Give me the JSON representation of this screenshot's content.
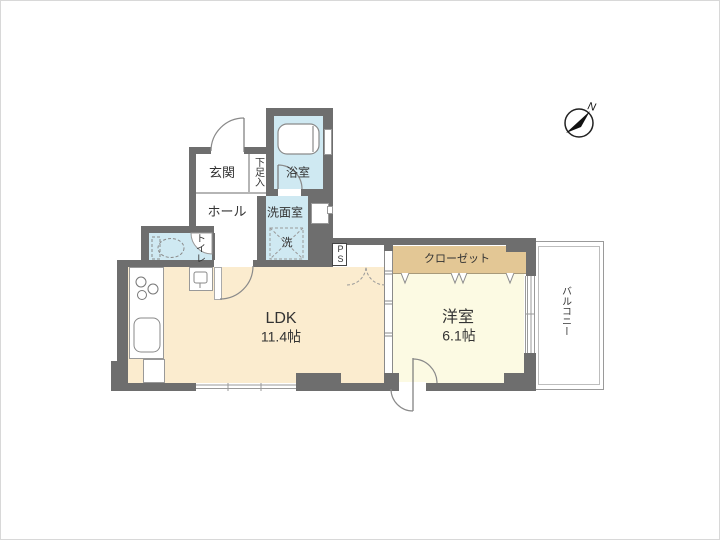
{
  "plan": {
    "type": "apartment-floor-plan",
    "rooms": {
      "genkan": {
        "label": "玄関"
      },
      "shoebox": {
        "label": "下足入"
      },
      "hall": {
        "label": "ホール"
      },
      "bath": {
        "label": "浴室"
      },
      "washroom": {
        "label": "洗面室"
      },
      "washer": {
        "label": "洗"
      },
      "toilet": {
        "label": "トイレ"
      },
      "ps": {
        "label": "PS"
      },
      "ldk": {
        "label": "LDK",
        "size": "11.4帖"
      },
      "closet": {
        "label": "クローゼット"
      },
      "western": {
        "label": "洋室",
        "size": "6.1帖"
      },
      "balcony": {
        "label": "バルコニー"
      }
    },
    "compass": {
      "label": "N"
    }
  },
  "colors": {
    "wall": "#6e6e6e",
    "ldk_floor": "#fbeccf",
    "room_floor": "#fcfae3",
    "closet": "#e3c795",
    "wet_floor": "#cfe9f2",
    "line": "#8a8a8a",
    "text": "#333333"
  }
}
